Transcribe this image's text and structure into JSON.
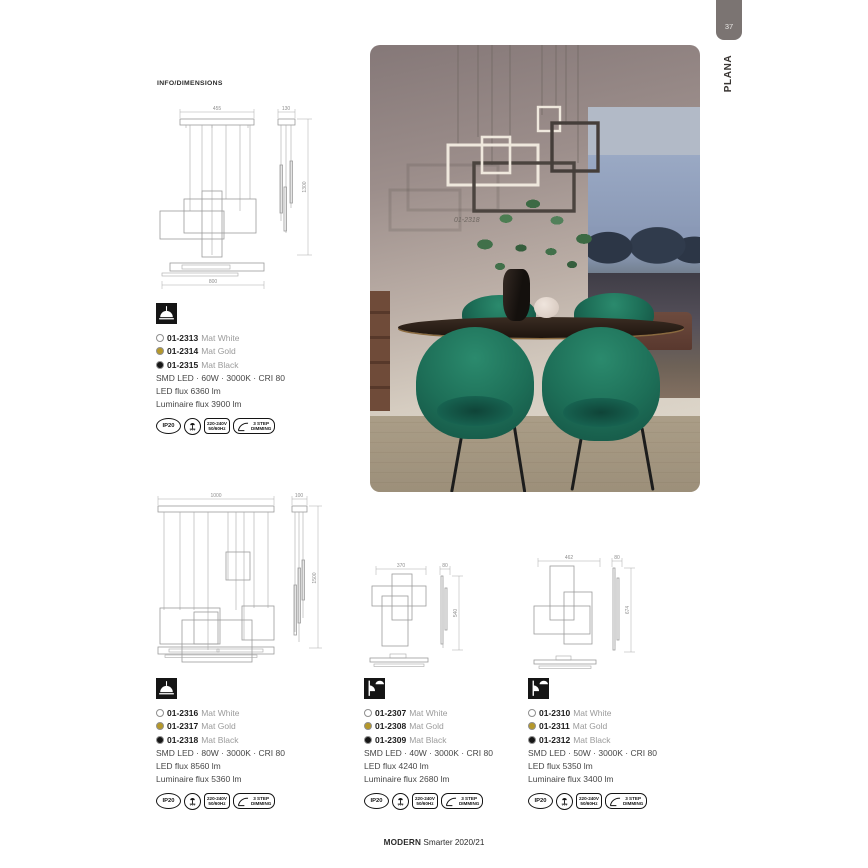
{
  "page": {
    "number": "37",
    "tab": "PLANA",
    "section": "INFO/DIMENSIONS",
    "footer_bold": "MODERN",
    "footer_rest": " Smarter 2020/21"
  },
  "photo": {
    "caption": "01-2318"
  },
  "drawings": {
    "d1": {
      "front_width": "455",
      "side_width": "130",
      "height": "1300",
      "plan_width": "800"
    },
    "d2": {
      "front_width": "1000",
      "side_width": "100",
      "height": "1500"
    },
    "d3": {
      "front_width": "370",
      "side_width": "80",
      "height": "540"
    },
    "d4": {
      "front_width": "462",
      "side_width": "80",
      "height": "674"
    }
  },
  "badges": {
    "ip": "IP20",
    "volt1": "220-240V",
    "volt2": "50/60Hz",
    "dim1": "3 STEP",
    "dim2": "DIMMING"
  },
  "colors": {
    "accent_gold": "#b5982a",
    "black": "#161616",
    "white": "#ffffff"
  },
  "products": [
    {
      "mount": "pendant",
      "variants": [
        {
          "code": "01-2313",
          "finish": "Mat White",
          "dot": "#ffffff"
        },
        {
          "code": "01-2314",
          "finish": "Mat Gold",
          "dot": "#b5982a"
        },
        {
          "code": "01-2315",
          "finish": "Mat Black",
          "dot": "#161616"
        }
      ],
      "specs": [
        "SMD LED · 60W · 3000K · CRI 80",
        "LED flux 6360 lm",
        "Luminaire flux 3900 lm"
      ]
    },
    {
      "mount": "pendant",
      "variants": [
        {
          "code": "01-2316",
          "finish": "Mat White",
          "dot": "#ffffff"
        },
        {
          "code": "01-2317",
          "finish": "Mat Gold",
          "dot": "#b5982a"
        },
        {
          "code": "01-2318",
          "finish": "Mat Black",
          "dot": "#161616"
        }
      ],
      "specs": [
        "SMD LED · 80W · 3000K · CRI 80",
        "LED flux 8560 lm",
        "Luminaire flux 5360 lm"
      ]
    },
    {
      "mount": "wall-ceiling",
      "variants": [
        {
          "code": "01-2307",
          "finish": "Mat White",
          "dot": "#ffffff"
        },
        {
          "code": "01-2308",
          "finish": "Mat Gold",
          "dot": "#b5982a"
        },
        {
          "code": "01-2309",
          "finish": "Mat Black",
          "dot": "#161616"
        }
      ],
      "specs": [
        "SMD LED · 40W · 3000K · CRI 80",
        "LED flux 4240 lm",
        "Luminaire flux 2680 lm"
      ]
    },
    {
      "mount": "wall-ceiling",
      "variants": [
        {
          "code": "01-2310",
          "finish": "Mat White",
          "dot": "#ffffff"
        },
        {
          "code": "01-2311",
          "finish": "Mat Gold",
          "dot": "#b5982a"
        },
        {
          "code": "01-2312",
          "finish": "Mat Black",
          "dot": "#161616"
        }
      ],
      "specs": [
        "SMD LED · 50W · 3000K · CRI 80",
        "LED flux 5350 lm",
        "Luminaire flux 3400 lm"
      ]
    }
  ]
}
